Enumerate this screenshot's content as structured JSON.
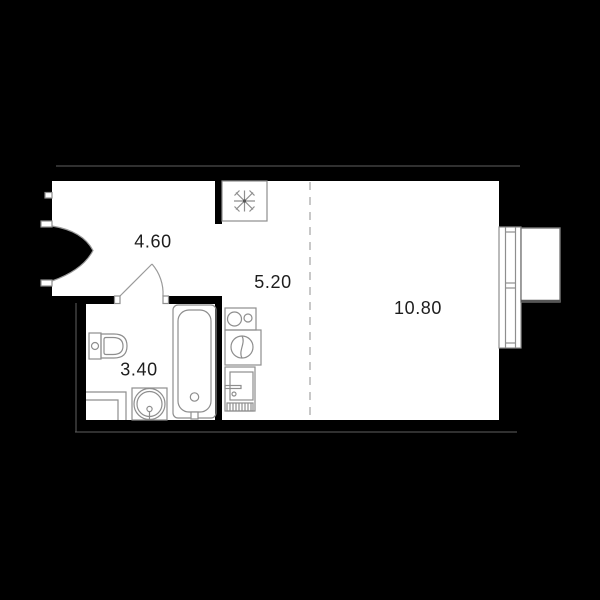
{
  "plan": {
    "title": "studio apartment floor plan",
    "rooms": [
      {
        "id": "hallway",
        "area_label": "4.60"
      },
      {
        "id": "kitchen",
        "area_label": "5.20"
      },
      {
        "id": "living-room",
        "area_label": "10.80"
      },
      {
        "id": "bathroom",
        "area_label": "3.40"
      }
    ],
    "fixtures": [
      "entrance-door",
      "interior-door",
      "ventilation-shaft",
      "toilet",
      "shower-tray",
      "wash-basin",
      "bathtub",
      "kitchen-sink",
      "cooktop",
      "refrigerator",
      "window",
      "balcony",
      "zoning-line"
    ],
    "colors": {
      "background": "#000000",
      "floor": "#ffffff",
      "walls": "#000000",
      "fixture_line": "#8e8e8e",
      "slab_line": "#5f5f5f",
      "label_text": "#1d1d1d"
    }
  }
}
